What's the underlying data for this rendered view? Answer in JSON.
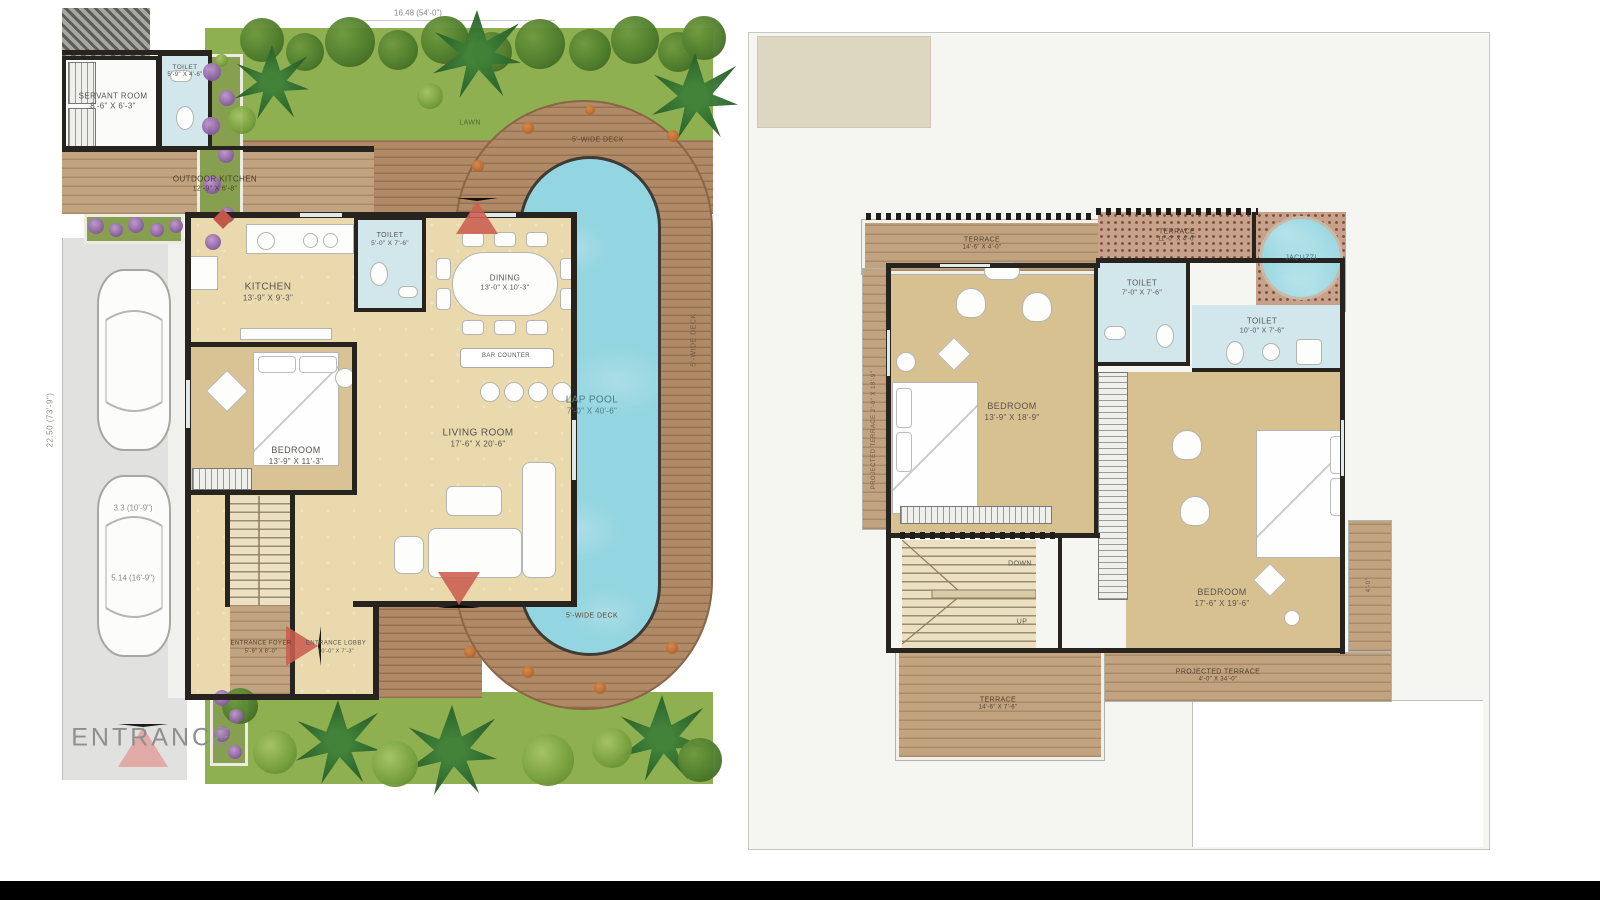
{
  "ground_floor": {
    "dim_top": "16.48 (54'-0\")",
    "dim_left": "22.50 (73'-9\")",
    "lawn": "LAWN",
    "entrance": "ENTRANCE",
    "deck_top": "5'-WIDE DECK",
    "deck_bottom": "5'-WIDE DECK",
    "deck_right": "5'-WIDE DECK",
    "car1_dim": "3.3 (10'-9\")",
    "car2_dim": "5.14 (16'-9\")",
    "rooms": {
      "servant": {
        "name": "SERVANT ROOM",
        "dims": "8'-6\" x 6'-3\""
      },
      "toilet_top": {
        "name": "TOILET",
        "dims": "5'-9\" x 4'-6\""
      },
      "outdoor_kitchen": {
        "name": "OUTDOOR KITCHEN",
        "dims": "12'-9\" x 6'-8\""
      },
      "kitchen": {
        "name": "KITCHEN",
        "dims": "13'-9\" x 9'-3\""
      },
      "toilet": {
        "name": "TOILET",
        "dims": "5'-0\" x 7'-6\""
      },
      "dining": {
        "name": "DINING",
        "dims": "13'-0\" x 10'-3\""
      },
      "bar": {
        "name": "BAR COUNTER"
      },
      "bedroom": {
        "name": "BEDROOM",
        "dims": "13'-9\" x 11'-3\""
      },
      "living": {
        "name": "LIVING ROOM",
        "dims": "17'-6\" x 20'-6\""
      },
      "foyer": {
        "name": "ENTRANCE FOYER",
        "dims": "5'-9\" x 8'-0\""
      },
      "lobby": {
        "name": "ENTRANCE LOBBY",
        "dims": "10'-0\" x 7'-3\""
      },
      "pool": {
        "name": "LAP POOL",
        "dims": "7'-0\" x 40'-6\""
      }
    }
  },
  "first_floor": {
    "rooms": {
      "terrace_left": {
        "name": "TERRACE",
        "dims": "14'-6\" x 4'-0\""
      },
      "proj_terrace_left": {
        "name": "PROJECTED TERRACE",
        "dims": "2'-0\" x 18'-9\""
      },
      "terrace_top": {
        "name": "TERRACE",
        "dims": "11'-0\" x 4'-0\""
      },
      "jacuzzi": {
        "name": "JACUZZI"
      },
      "toilet1": {
        "name": "TOILET",
        "dims": "7'-0\" x 7'-6\""
      },
      "toilet2": {
        "name": "TOILET",
        "dims": "10'-0\" x 7'-6\""
      },
      "bedroom1": {
        "name": "BEDROOM",
        "dims": "13'-9\" x 18'-9\""
      },
      "bedroom2": {
        "name": "BEDROOM",
        "dims": "17'-6\" x 19'-6\""
      },
      "proj_terrace_bottom": {
        "name": "PROJECTED TERRACE",
        "dims": "4'-0\" x 34'-0\""
      },
      "terrace_bottom": {
        "name": "TERRACE",
        "dims": "14'-6\" x 7'-6\""
      },
      "side_dim": "4'-0\""
    },
    "stairs": {
      "down": "DOWN",
      "up": "UP"
    }
  },
  "colors": {
    "wall": "#272420",
    "pool": "#93d5e0",
    "deck_wood": "#b08a66",
    "lawn": "#8fb050",
    "interior_beige": "#e9d9ad",
    "bedroom_tan": "#d8c190",
    "toilet_blue": "#d2e7ec",
    "arrow_red": "#cb5f50",
    "entrance_arrow_pink": "#e2a3a0",
    "page_gray": "#f5f5f2",
    "flower_purple": "#8f62a6",
    "bottom_bar": "#000000"
  }
}
